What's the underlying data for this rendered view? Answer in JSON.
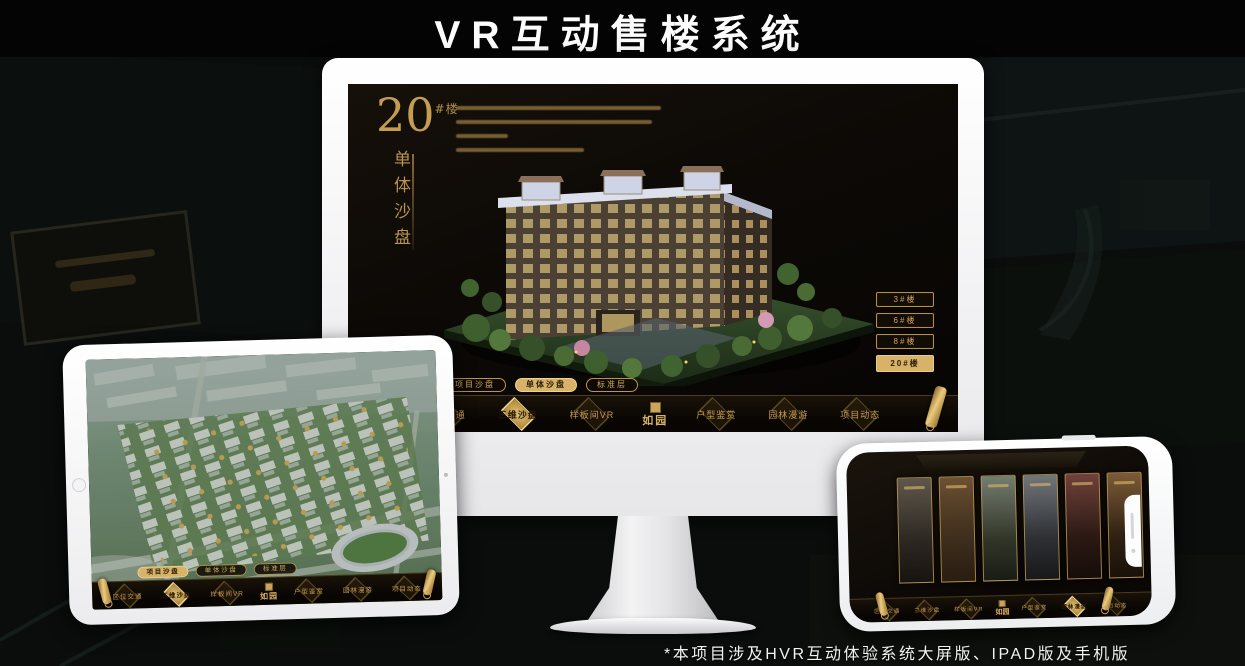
{
  "header": {
    "title": "VR互动售楼系统"
  },
  "footer": {
    "note": "*本项目涉及HVR互动体验系统大屏版、IPAD版及手机版"
  },
  "colors": {
    "gold": "#c9a45c",
    "gold_selected_bg": "#d9b269",
    "selected_text": "#2a1d08",
    "screen_bg": "#0c0906",
    "device_white": "#f4f4f6"
  },
  "nav": {
    "logo": "如园",
    "items": [
      "区位交通",
      "三维沙盘",
      "样板间VR",
      "户型鉴赏",
      "园林漫游",
      "项目动态"
    ]
  },
  "sub_tabs": {
    "items": [
      "项目沙盘",
      "单体沙盘",
      "标准层"
    ]
  },
  "monitor": {
    "building_number": "20",
    "building_suffix": "#楼",
    "panel_title_vertical": "单体沙盘",
    "floor_buttons": [
      {
        "label": "3#楼",
        "selected": false
      },
      {
        "label": "6#楼",
        "selected": false
      },
      {
        "label": "8#楼",
        "selected": false
      },
      {
        "label": "20#楼",
        "selected": true
      }
    ]
  }
}
